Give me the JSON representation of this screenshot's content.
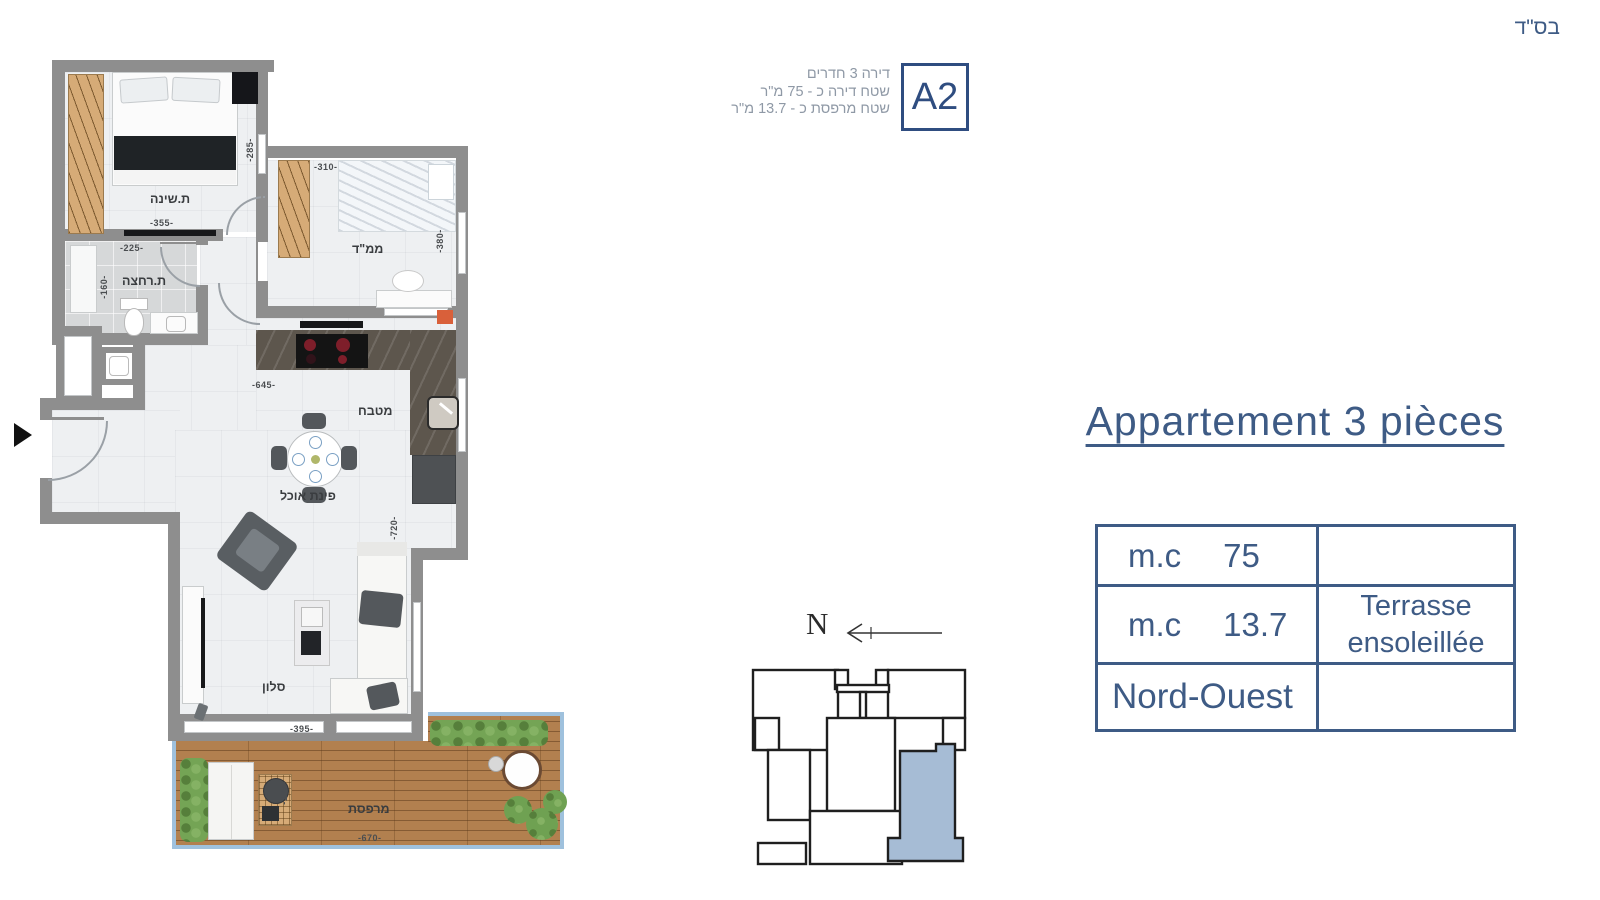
{
  "bsd": "בס\"ד",
  "header": {
    "unit_label": "A2",
    "info_lines": [
      "דירה 3 חדרים",
      "שטח דירה כ - 75 מ\"ר",
      "שטח מרפסת כ - 13.7 מ\"ר"
    ]
  },
  "panel": {
    "title": "Appartement 3 pièces",
    "table": {
      "rows": [
        {
          "label": "m.c",
          "value": "75",
          "note": ""
        },
        {
          "label": "m.c",
          "value": "13.7",
          "note": "Terrasse ensoleillée"
        },
        {
          "label": "Nord-Ouest",
          "value": "",
          "note": ""
        }
      ]
    }
  },
  "compass": {
    "north": "N"
  },
  "floorplan": {
    "rooms": {
      "bedroom": "ת.שינה",
      "bathroom": "ת.רחצה",
      "mamad": "ממ\"ד",
      "kitchen": "מטבח",
      "dining": "פינת אוכל",
      "living": "סלון",
      "terrace": "מרפסת"
    },
    "dims": {
      "bedroom_w": "-355-",
      "bedroom_h": "-285-",
      "bath_w": "-225-",
      "bath_h": "-160-",
      "mamad_w": "-310-",
      "mamad_h": "-380-",
      "kitchen_w": "-645-",
      "living_h": "-720-",
      "living_w": "-395-",
      "terrace_w": "-670-",
      "terrace_h": "-175-"
    }
  },
  "colors": {
    "accent": "#3e5b85",
    "badge": "#2f4d80",
    "info_text": "#8f99a6",
    "wall": "#8e8e8e",
    "deck": "#b2804f",
    "railing": "#9fc1dd",
    "unit_highlight": "#a6bcd5",
    "hedge": "#74a455"
  }
}
